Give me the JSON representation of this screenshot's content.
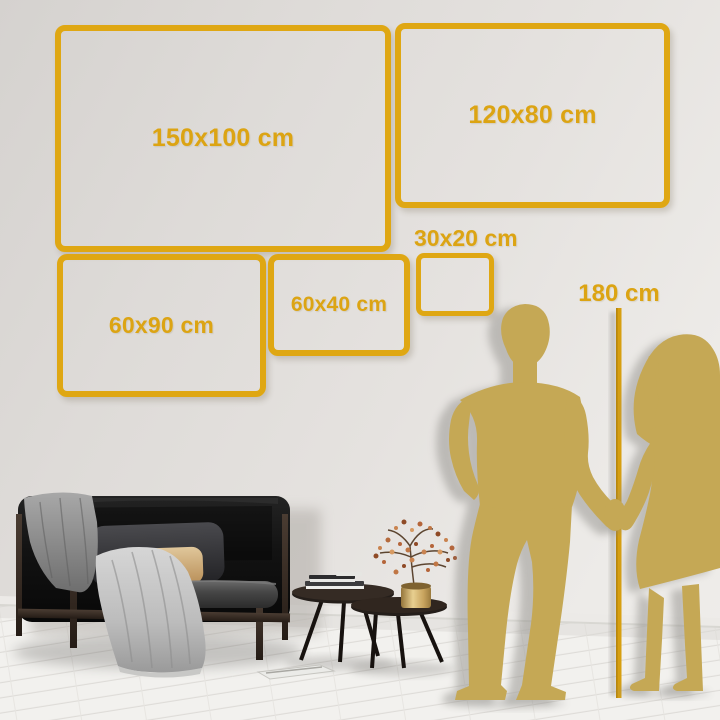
{
  "size_guide": {
    "frames": [
      {
        "id": "150x100",
        "label": "150x100 cm"
      },
      {
        "id": "120x80",
        "label": "120x80 cm"
      },
      {
        "id": "60x90",
        "label": "60x90 cm"
      },
      {
        "id": "60x40",
        "label": "60x40 cm"
      },
      {
        "id": "30x20",
        "label": "30x20 cm"
      }
    ],
    "height_marker": {
      "label": "180 cm"
    }
  },
  "colors": {
    "frame_gold": "#DFA713",
    "label_gold": "#DCA413",
    "measure_line_gold": "#D79F10",
    "silhouette_gold": "#C5A855",
    "wall": "#E2DFDC",
    "floor": "#F2F1EE",
    "sofa_black": "#121212",
    "pillow_tan": "#D2B483",
    "blanket_gray": "#B4B4B4"
  }
}
